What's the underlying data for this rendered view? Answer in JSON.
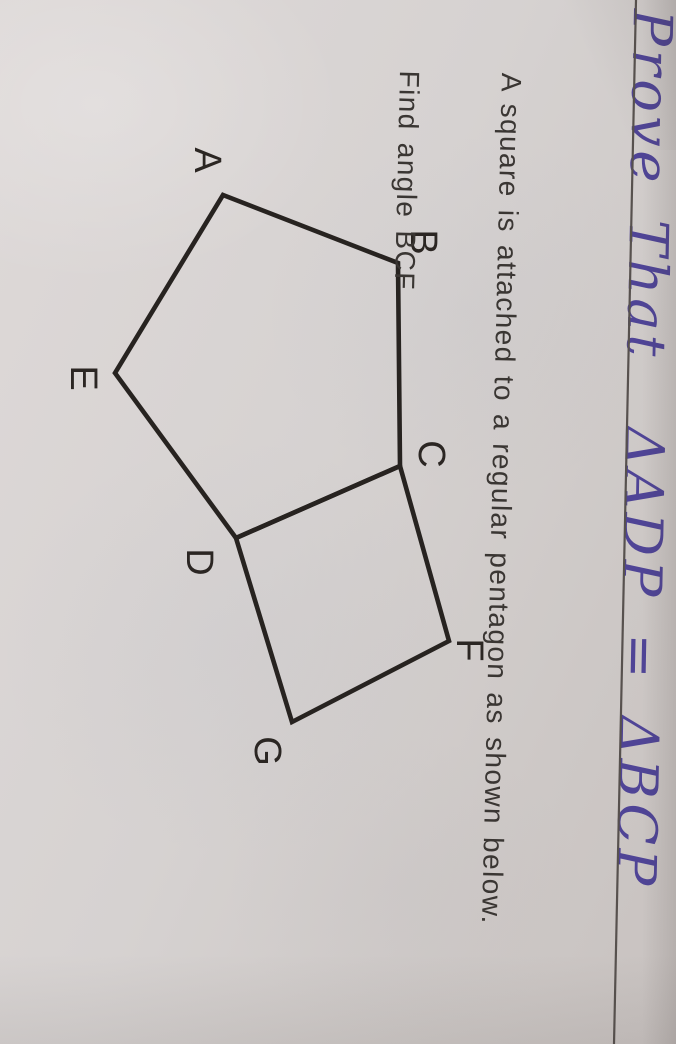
{
  "handwriting": {
    "text": "Prove That  ΔADP = ΔBCP",
    "color": "#4f4496"
  },
  "divider_line": {
    "x1": 0,
    "y1": 40,
    "x2": 1044,
    "y2": 62,
    "color": "#57514e",
    "width": 2.2
  },
  "problem": {
    "line1": "A square is attached to a regular pentagon as shown below.",
    "line2": "Find angle BCF",
    "color": "#3a3633"
  },
  "diagram": {
    "stroke": "#272320",
    "stroke_width": 4.6,
    "label_color": "#2b2623",
    "label_font_size": 38,
    "points": {
      "A": [
        195,
        453
      ],
      "B": [
        263,
        278
      ],
      "C": [
        466,
        276
      ],
      "D": [
        538,
        440
      ],
      "E": [
        373,
        561
      ],
      "F": [
        641,
        227
      ],
      "G": [
        722,
        384
      ]
    },
    "shapes": [
      {
        "name": "pentagon-ABCDE",
        "points": [
          "A",
          "B",
          "C",
          "D",
          "E"
        ]
      },
      {
        "name": "square-CFGD",
        "points": [
          "C",
          "F",
          "G",
          "D"
        ]
      }
    ],
    "labels": [
      {
        "text": "A",
        "x": 160,
        "y": 469
      },
      {
        "text": "B",
        "x": 242,
        "y": 253
      },
      {
        "text": "C",
        "x": 454,
        "y": 245
      },
      {
        "text": "D",
        "x": 562,
        "y": 477
      },
      {
        "text": "E",
        "x": 378,
        "y": 593
      },
      {
        "text": "F",
        "x": 650,
        "y": 207
      },
      {
        "text": "G",
        "x": 751,
        "y": 409
      }
    ]
  }
}
